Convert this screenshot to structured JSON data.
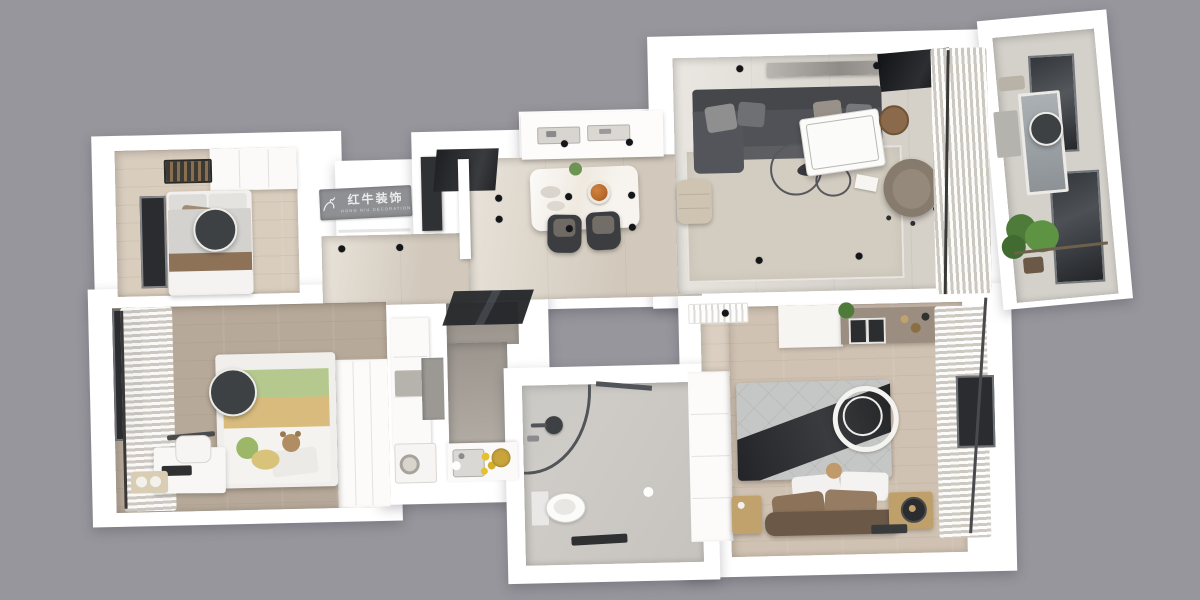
{
  "brand": {
    "logo_text": "红牛装饰",
    "logo_subtext": "HONG NIU DECORATION",
    "registered_mark": "®"
  },
  "colors": {
    "bg": "#97969c",
    "wall": "#ffffff",
    "wood-light": "#d9cdbe",
    "wood-taupe": "#b7a999",
    "wood-master": "#d0c2b2",
    "marble-beige": "#ddd4c6",
    "living-floor": "#e0dbd3",
    "rug": "#d3ccc0",
    "kitchen-floor": "#a29c95",
    "bath-floor": "#cdcac5",
    "balcony-floor": "#d4d0ca",
    "sofa": "#515257",
    "sofa-dark": "#46474b",
    "charcoal": "#3e4143",
    "black": "#202225",
    "chair-taupe": "#877b6e",
    "table-white": "#fbfbfa",
    "brown": "#8a6a4a",
    "comforter": "#c5c7c6",
    "runner-black": "#2a2b2d",
    "pillow-brown": "#8b7258",
    "bench-brown": "#6b5847",
    "green": "#b5c98e",
    "tan": "#d8bb7d",
    "plush-green": "#9cb768",
    "plush-yellow": "#d9c27a",
    "teddy": "#b08d62",
    "plant": "#4e7b39",
    "gold": "#c2a26c",
    "taupe-cab": "#9b8d80",
    "curtain-shade": "#dcd8d1",
    "logo-bg": "#8f9094",
    "logo-fg": "#ececec",
    "glass": "#34373b",
    "window-dark": "#2a2c2f",
    "dish-orange": "#b96a2c",
    "lemon": "#e3c12f"
  },
  "lighting": {
    "spotlights": [
      [
        343,
        243
      ],
      [
        401,
        243
      ],
      [
        501,
        196
      ],
      [
        501,
        217
      ],
      [
        568,
        143
      ],
      [
        633,
        143
      ],
      [
        571,
        196
      ],
      [
        634,
        196
      ],
      [
        571,
        228
      ],
      [
        634,
        228
      ],
      [
        745,
        72
      ],
      [
        882,
        72
      ],
      [
        760,
        264
      ],
      [
        860,
        262
      ],
      [
        725,
        316
      ]
    ],
    "round_lamps": [
      [
        217,
        221,
        20
      ],
      [
        231,
        384,
        22
      ],
      [
        1050,
        139,
        15
      ]
    ]
  },
  "rooms": [
    {
      "id": "guest-bedroom",
      "furniture": [
        "single-bed",
        "wardrobe",
        "window",
        "round-ceiling-lamp",
        "luggage-rack"
      ]
    },
    {
      "id": "entry-hall",
      "furniture": [
        "brand-sign",
        "shoe-cabinet",
        "front-door",
        "partition-wall"
      ]
    },
    {
      "id": "dining-area",
      "furniture": [
        "sideboard",
        "dining-table",
        "dining-chairs",
        "pizza-dish",
        "table-plant",
        "ceiling-spotlights"
      ]
    },
    {
      "id": "living-room",
      "furniture": [
        "sectional-sofa",
        "tv-panel",
        "media-shelf",
        "area-rug",
        "white-desk",
        "desk-chair",
        "wire-coffee-tables",
        "ottoman",
        "round-side-table",
        "sheer-curtain"
      ]
    },
    {
      "id": "balcony",
      "furniture": [
        "glazed-windows",
        "mirror-panel",
        "potted-plant",
        "round-ceiling-lamp",
        "utility-fixtures",
        "curtain-rod"
      ]
    },
    {
      "id": "kids-bedroom",
      "furniture": [
        "bed-green-tan",
        "plush-toys",
        "desk",
        "desk-chair",
        "window-curtains",
        "round-ceiling-lamp",
        "wardrobe"
      ]
    },
    {
      "id": "kitchen",
      "furniture": [
        "sliding-glass-door",
        "counters",
        "sink",
        "fruit-basket",
        "washing-machine",
        "fridge-panel"
      ]
    },
    {
      "id": "bathroom",
      "furniture": [
        "curved-shower-enclosure",
        "shower-head",
        "glass-partition",
        "toilet",
        "bath-mat",
        "floor-drain"
      ]
    },
    {
      "id": "master-bedroom",
      "furniture": [
        "double-bed",
        "ring-ceiling-light",
        "nightstands",
        "table-lamp",
        "tv-cabinet",
        "wardrobe",
        "air-conditioner",
        "window-curtains"
      ]
    }
  ]
}
